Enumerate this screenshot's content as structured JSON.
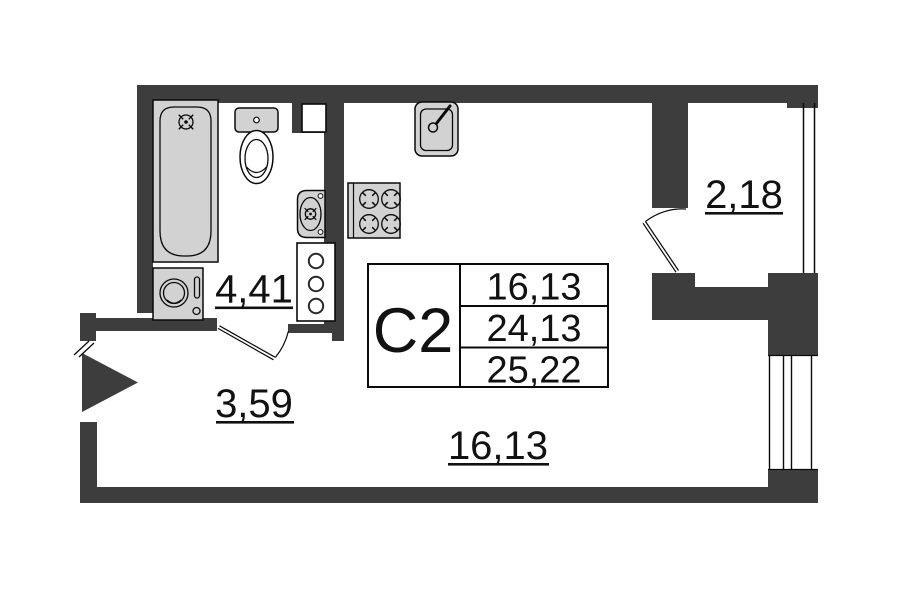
{
  "unit": {
    "code": "С2"
  },
  "area_table": {
    "rows": [
      "16,13",
      "24,13",
      "25,22"
    ]
  },
  "room_labels": {
    "bathroom": "4,41",
    "hallway": "3,59",
    "living": "16,13",
    "balcony": "2,18"
  },
  "fixtures": [
    "bathtub",
    "toilet",
    "washbasin",
    "washing-machine",
    "riser-shaft",
    "vent-shaft",
    "stove",
    "kitchen-sink",
    "entrance-arrow",
    "balcony-glazing",
    "window"
  ],
  "colors": {
    "wall": "#3d3d3d",
    "fixture": "#d2d2d2",
    "line": "#0a0a0a",
    "text": "#111111",
    "background": "#ffffff"
  }
}
